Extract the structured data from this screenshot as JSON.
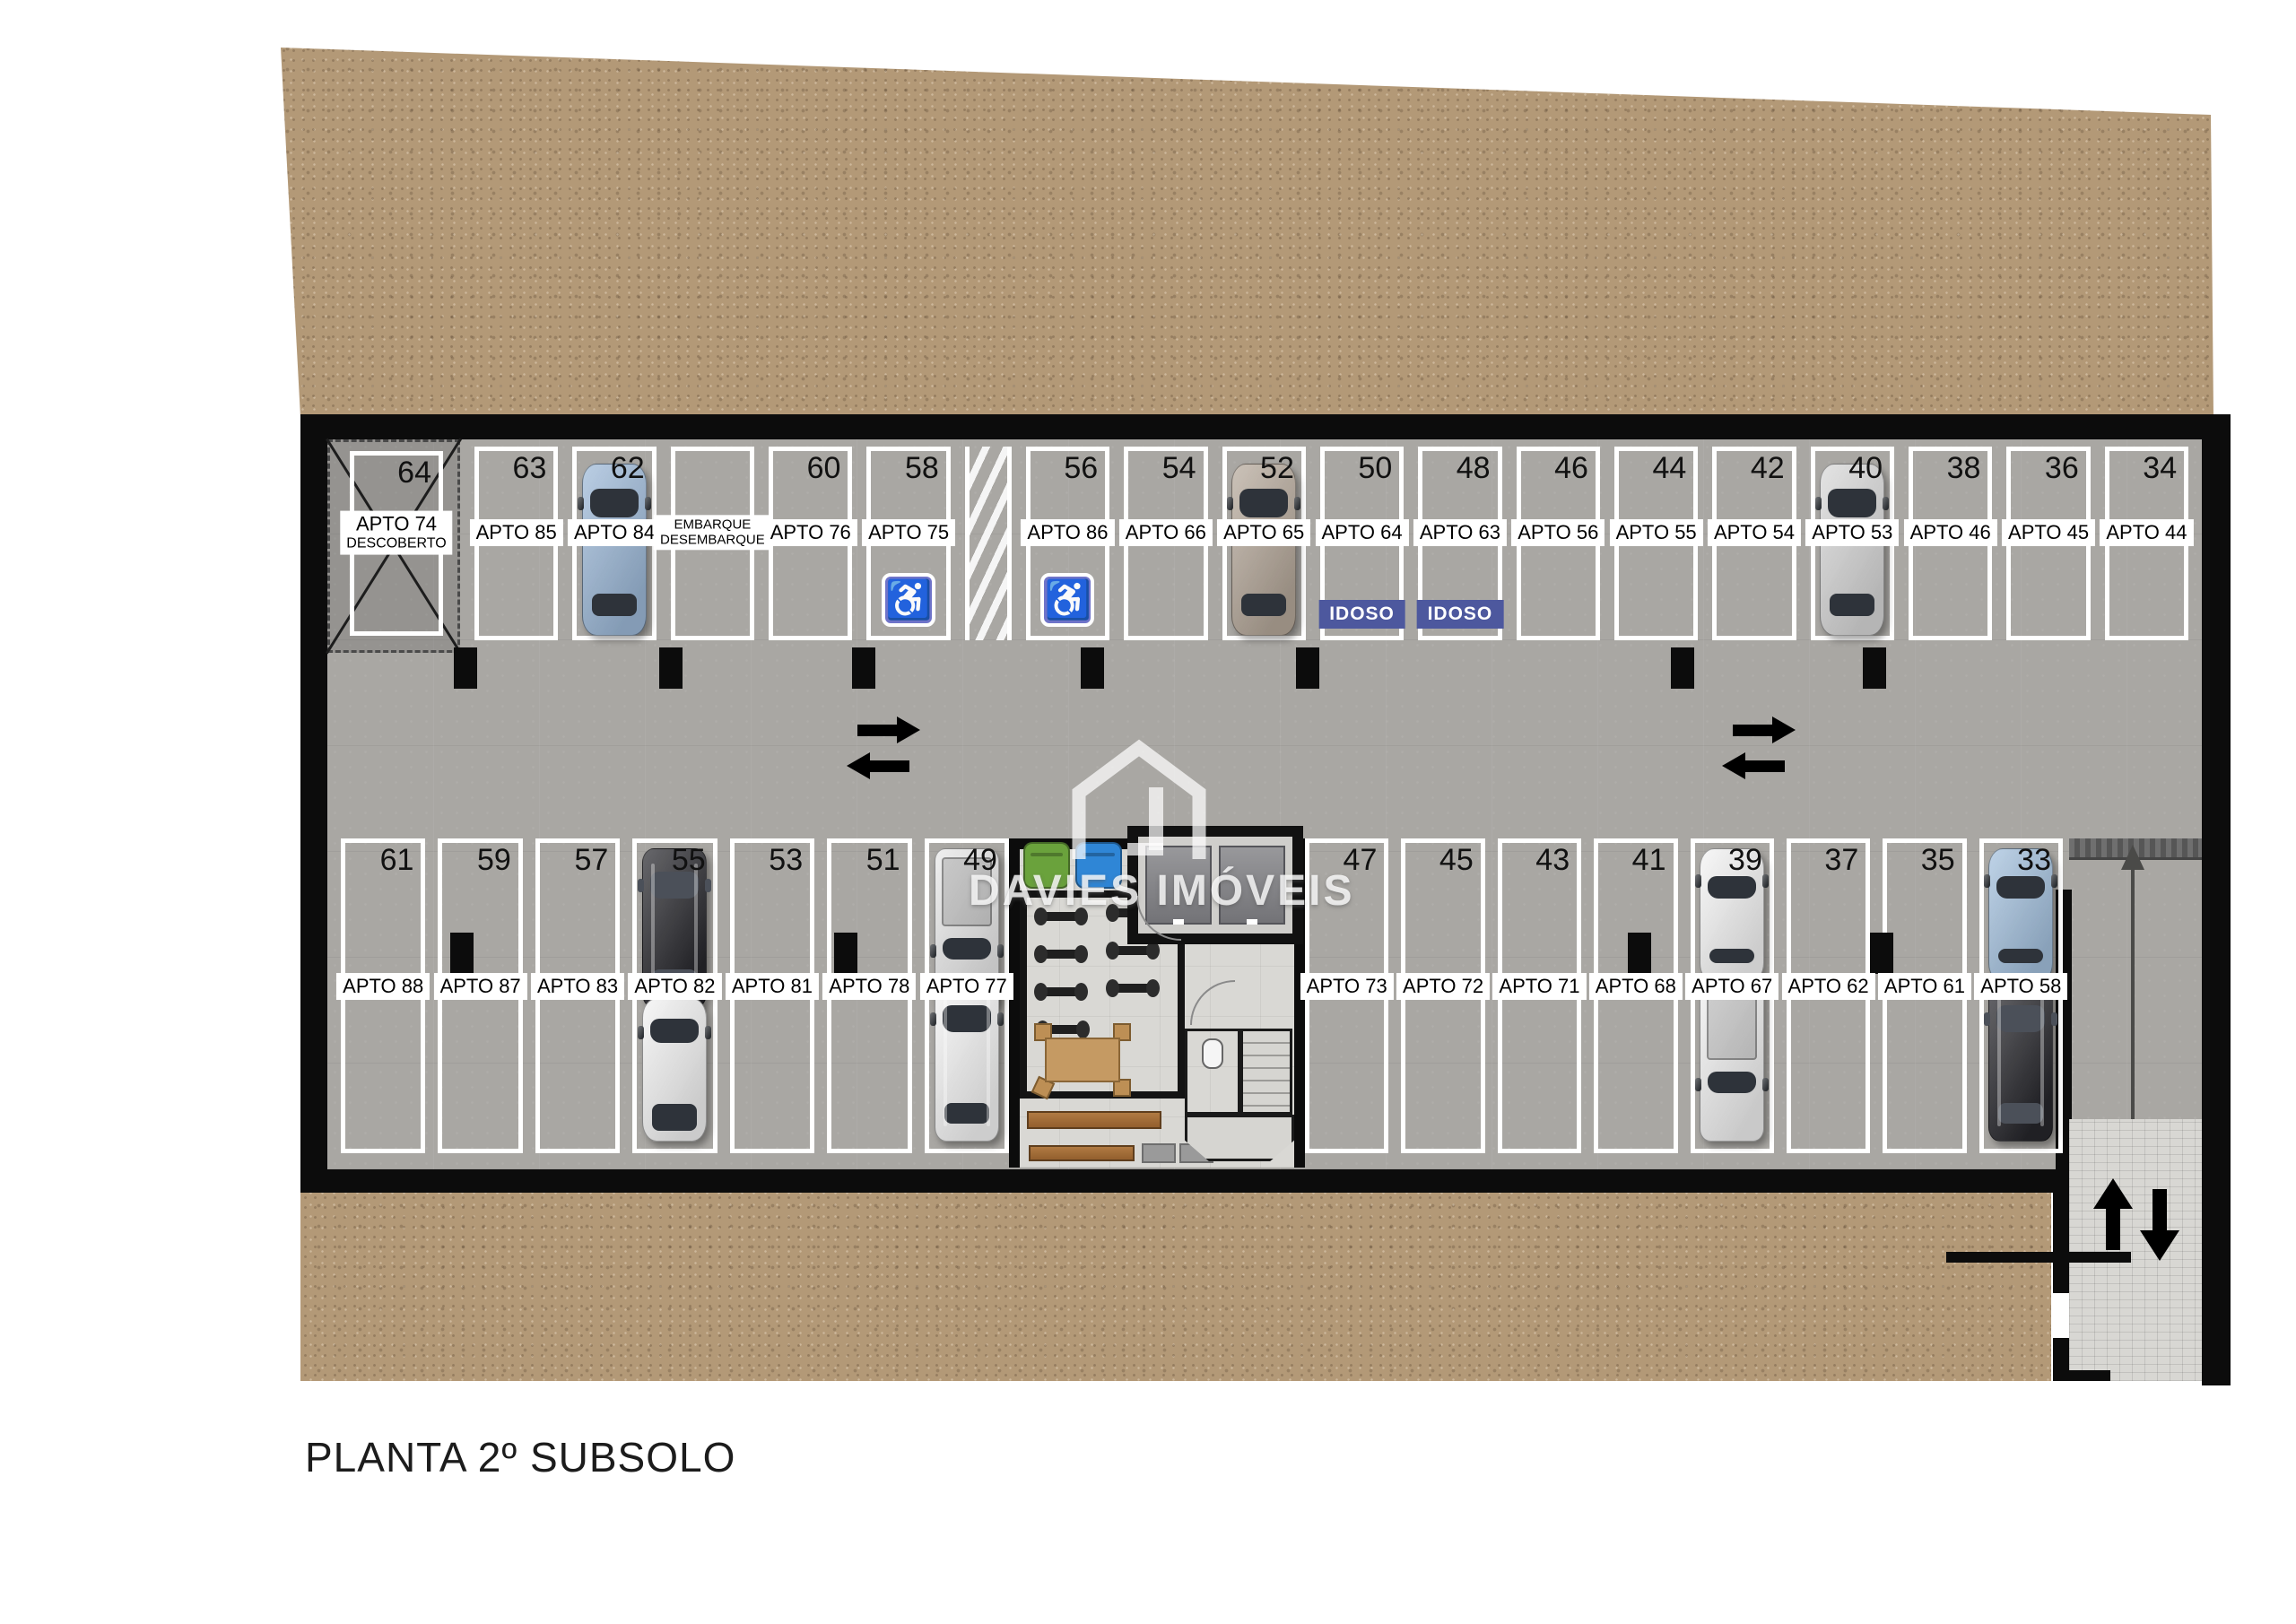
{
  "title": "PLANTA 2º SUBSOLO",
  "brand": "DAVIES IMÓVEIS",
  "signs": {
    "idoso": "IDOSO",
    "handicap_glyph": "♿"
  },
  "colors": {
    "dirt": "#b39977",
    "concrete": "#a9a7a3",
    "hall": "#d9d8d4",
    "wall": "#0c0c0c",
    "idoso": "#4d589e",
    "handicap": "#6f74c9",
    "bin_green": "#6aa23c",
    "bin_blue": "#2f86d6",
    "wood": "#c59a63",
    "title_text": "#1c1c1c"
  },
  "car_styles": {
    "blue-sedan": {
      "body": "#9db9d8",
      "kind": "sedan"
    },
    "tan-sedan": {
      "body": "#b5a89a",
      "kind": "sedan"
    },
    "silver-sedan": {
      "body": "#d8d8d8",
      "kind": "sedan"
    },
    "black-suv": {
      "body": "#26262b",
      "kind": "suv",
      "dark": true
    },
    "white-hatch": {
      "body": "#f2f2f2",
      "kind": "hatch"
    },
    "silver-pickup": {
      "body": "#e8e8e8",
      "kind": "pickup"
    },
    "white-suv": {
      "body": "#f4f4f4",
      "kind": "suv"
    },
    "white-sport": {
      "body": "#f4f4f4",
      "kind": "sport"
    },
    "white-pickup": {
      "body": "#f0f0f0",
      "kind": "pickup"
    },
    "blue-sport": {
      "body": "#a3c0dd",
      "kind": "sport"
    }
  },
  "top_row": [
    {
      "number": "64",
      "label": "APTO 74",
      "label2": "DESCOBERTO",
      "type": "descoberto"
    },
    {
      "number": "63",
      "label": "APTO 85"
    },
    {
      "number": "62",
      "label": "APTO 84",
      "car": "blue-sedan"
    },
    {
      "label": "EMBARQUE",
      "label2": "DESEMBARQUE",
      "type": "embarque"
    },
    {
      "number": "60",
      "label": "APTO 76"
    },
    {
      "number": "58",
      "label": "APTO 75",
      "badge": "handicap"
    },
    {
      "type": "hatch"
    },
    {
      "number": "56",
      "label": "APTO 86",
      "badge": "handicap"
    },
    {
      "number": "54",
      "label": "APTO 66"
    },
    {
      "number": "52",
      "label": "APTO 65",
      "car": "tan-sedan"
    },
    {
      "number": "50",
      "label": "APTO 64",
      "badge": "idoso"
    },
    {
      "number": "48",
      "label": "APTO 63",
      "badge": "idoso"
    },
    {
      "number": "46",
      "label": "APTO 56"
    },
    {
      "number": "44",
      "label": "APTO 55"
    },
    {
      "number": "42",
      "label": "APTO 54"
    },
    {
      "number": "40",
      "label": "APTO 53",
      "car": "silver-sedan"
    },
    {
      "number": "38",
      "label": "APTO 46"
    },
    {
      "number": "36",
      "label": "APTO 45"
    },
    {
      "number": "34",
      "label": "APTO 44"
    }
  ],
  "bottom_row_left": [
    {
      "number": "61",
      "label": "APTO 88"
    },
    {
      "number": "59",
      "label": "APTO 87"
    },
    {
      "number": "57",
      "label": "APTO 83"
    },
    {
      "number": "55",
      "label": "APTO 82",
      "car_top": "black-suv",
      "car_bottom": "white-hatch"
    },
    {
      "number": "53",
      "label": "APTO 81"
    },
    {
      "number": "51",
      "label": "APTO 78"
    },
    {
      "number": "49",
      "label": "APTO 77",
      "car_top": "silver-pickup",
      "car_bottom": "white-suv"
    }
  ],
  "bottom_row_right": [
    {
      "number": "47",
      "label": "APTO 73"
    },
    {
      "number": "45",
      "label": "APTO 72"
    },
    {
      "number": "43",
      "label": "APTO 71"
    },
    {
      "number": "41",
      "label": "APTO 68"
    },
    {
      "number": "39",
      "label": "APTO 67",
      "car_top": "white-sport",
      "car_bottom": "white-pickup"
    },
    {
      "number": "37",
      "label": "APTO 62"
    },
    {
      "number": "35",
      "label": "APTO 61"
    },
    {
      "number": "33",
      "label": "APTO 58",
      "car_top": "blue-sport",
      "car_bottom": "black-suv"
    }
  ]
}
